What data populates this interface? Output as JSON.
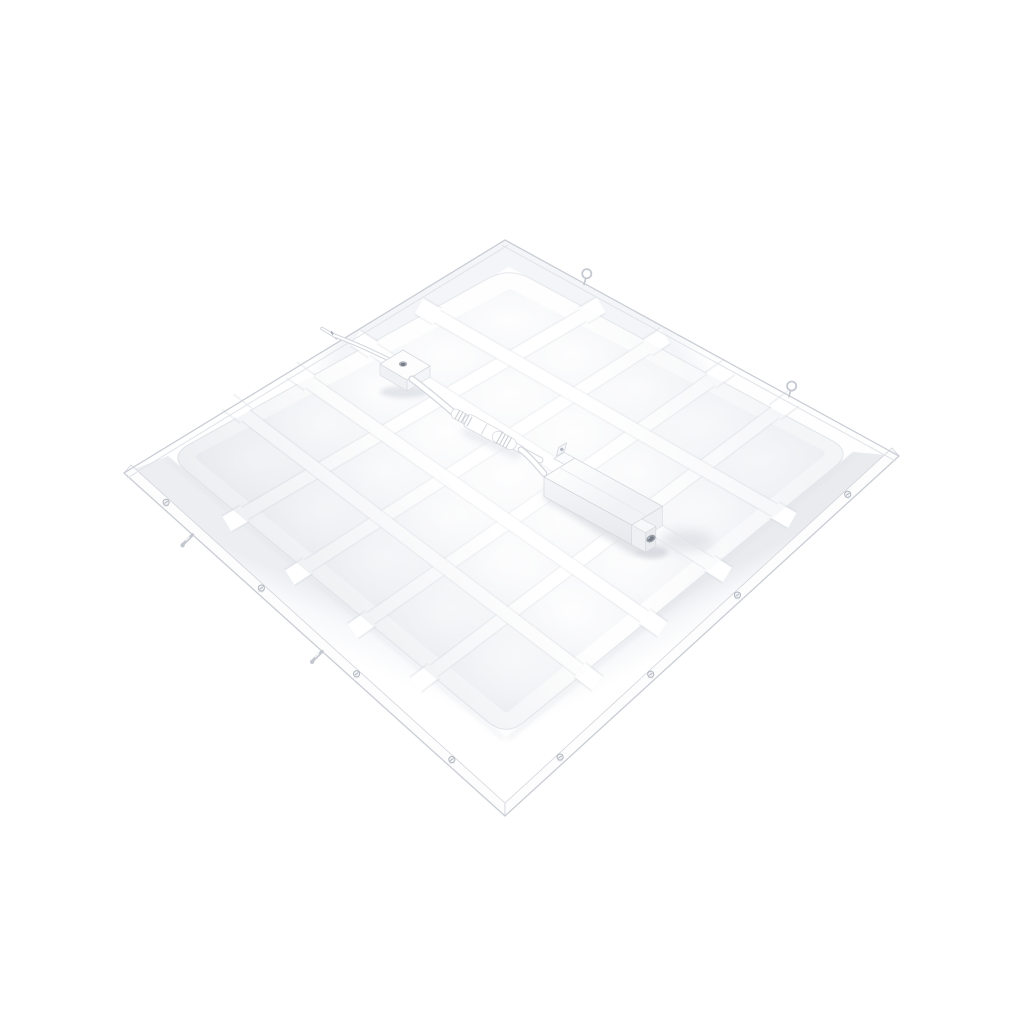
{
  "meta": {
    "title": "White square LED flat panel ceiling light, rear view with driver box and quick-connect cable",
    "background": "#ffffff"
  },
  "panel": {
    "shape": "square recessed LED panel viewed from the back at an angle (diamond orientation)",
    "grid": {
      "rows": 5,
      "cols": 5
    },
    "hardware": {
      "frame_screws_left": 4,
      "frame_screws_right": 4,
      "spring_clips": 2,
      "hanging_hooks": 2,
      "cable_edge_clips": 1
    }
  },
  "components": {
    "driver_label": "led-driver-box",
    "connector_label": "quick-connector",
    "junction_label": "junction-box",
    "cable_label": "power-cable",
    "back_label": "panel-back-grid",
    "frame_label": "mounting-frame"
  },
  "colors": {
    "background": "#ffffff",
    "panel_white": "#fefefe",
    "cell_gray": "#ebedf1",
    "cell_mid": "#f6f7f9",
    "cell_center": "#fdfdfe",
    "bar_white": "#ffffff",
    "bar_shadow": "#d6dae0",
    "slope_shade_br": "#e9ebef",
    "slope_shade_bl": "#eceef2",
    "slope_shade_top": "#f4f5f8",
    "frame_line": "#c9cdd4",
    "lip_line": "#e2e5e9",
    "face_white": "#fdfdfe",
    "metal": "#c3c7cf",
    "metal_dark": "#aab0b9",
    "port_dark": "#9aa0a9",
    "port_core": "#777d87",
    "shadow": "#dcdfe4",
    "shadow_soft": "#e2e5ea",
    "driver_side": "#eef0f3",
    "hole_dark": "#b4b9c1"
  }
}
